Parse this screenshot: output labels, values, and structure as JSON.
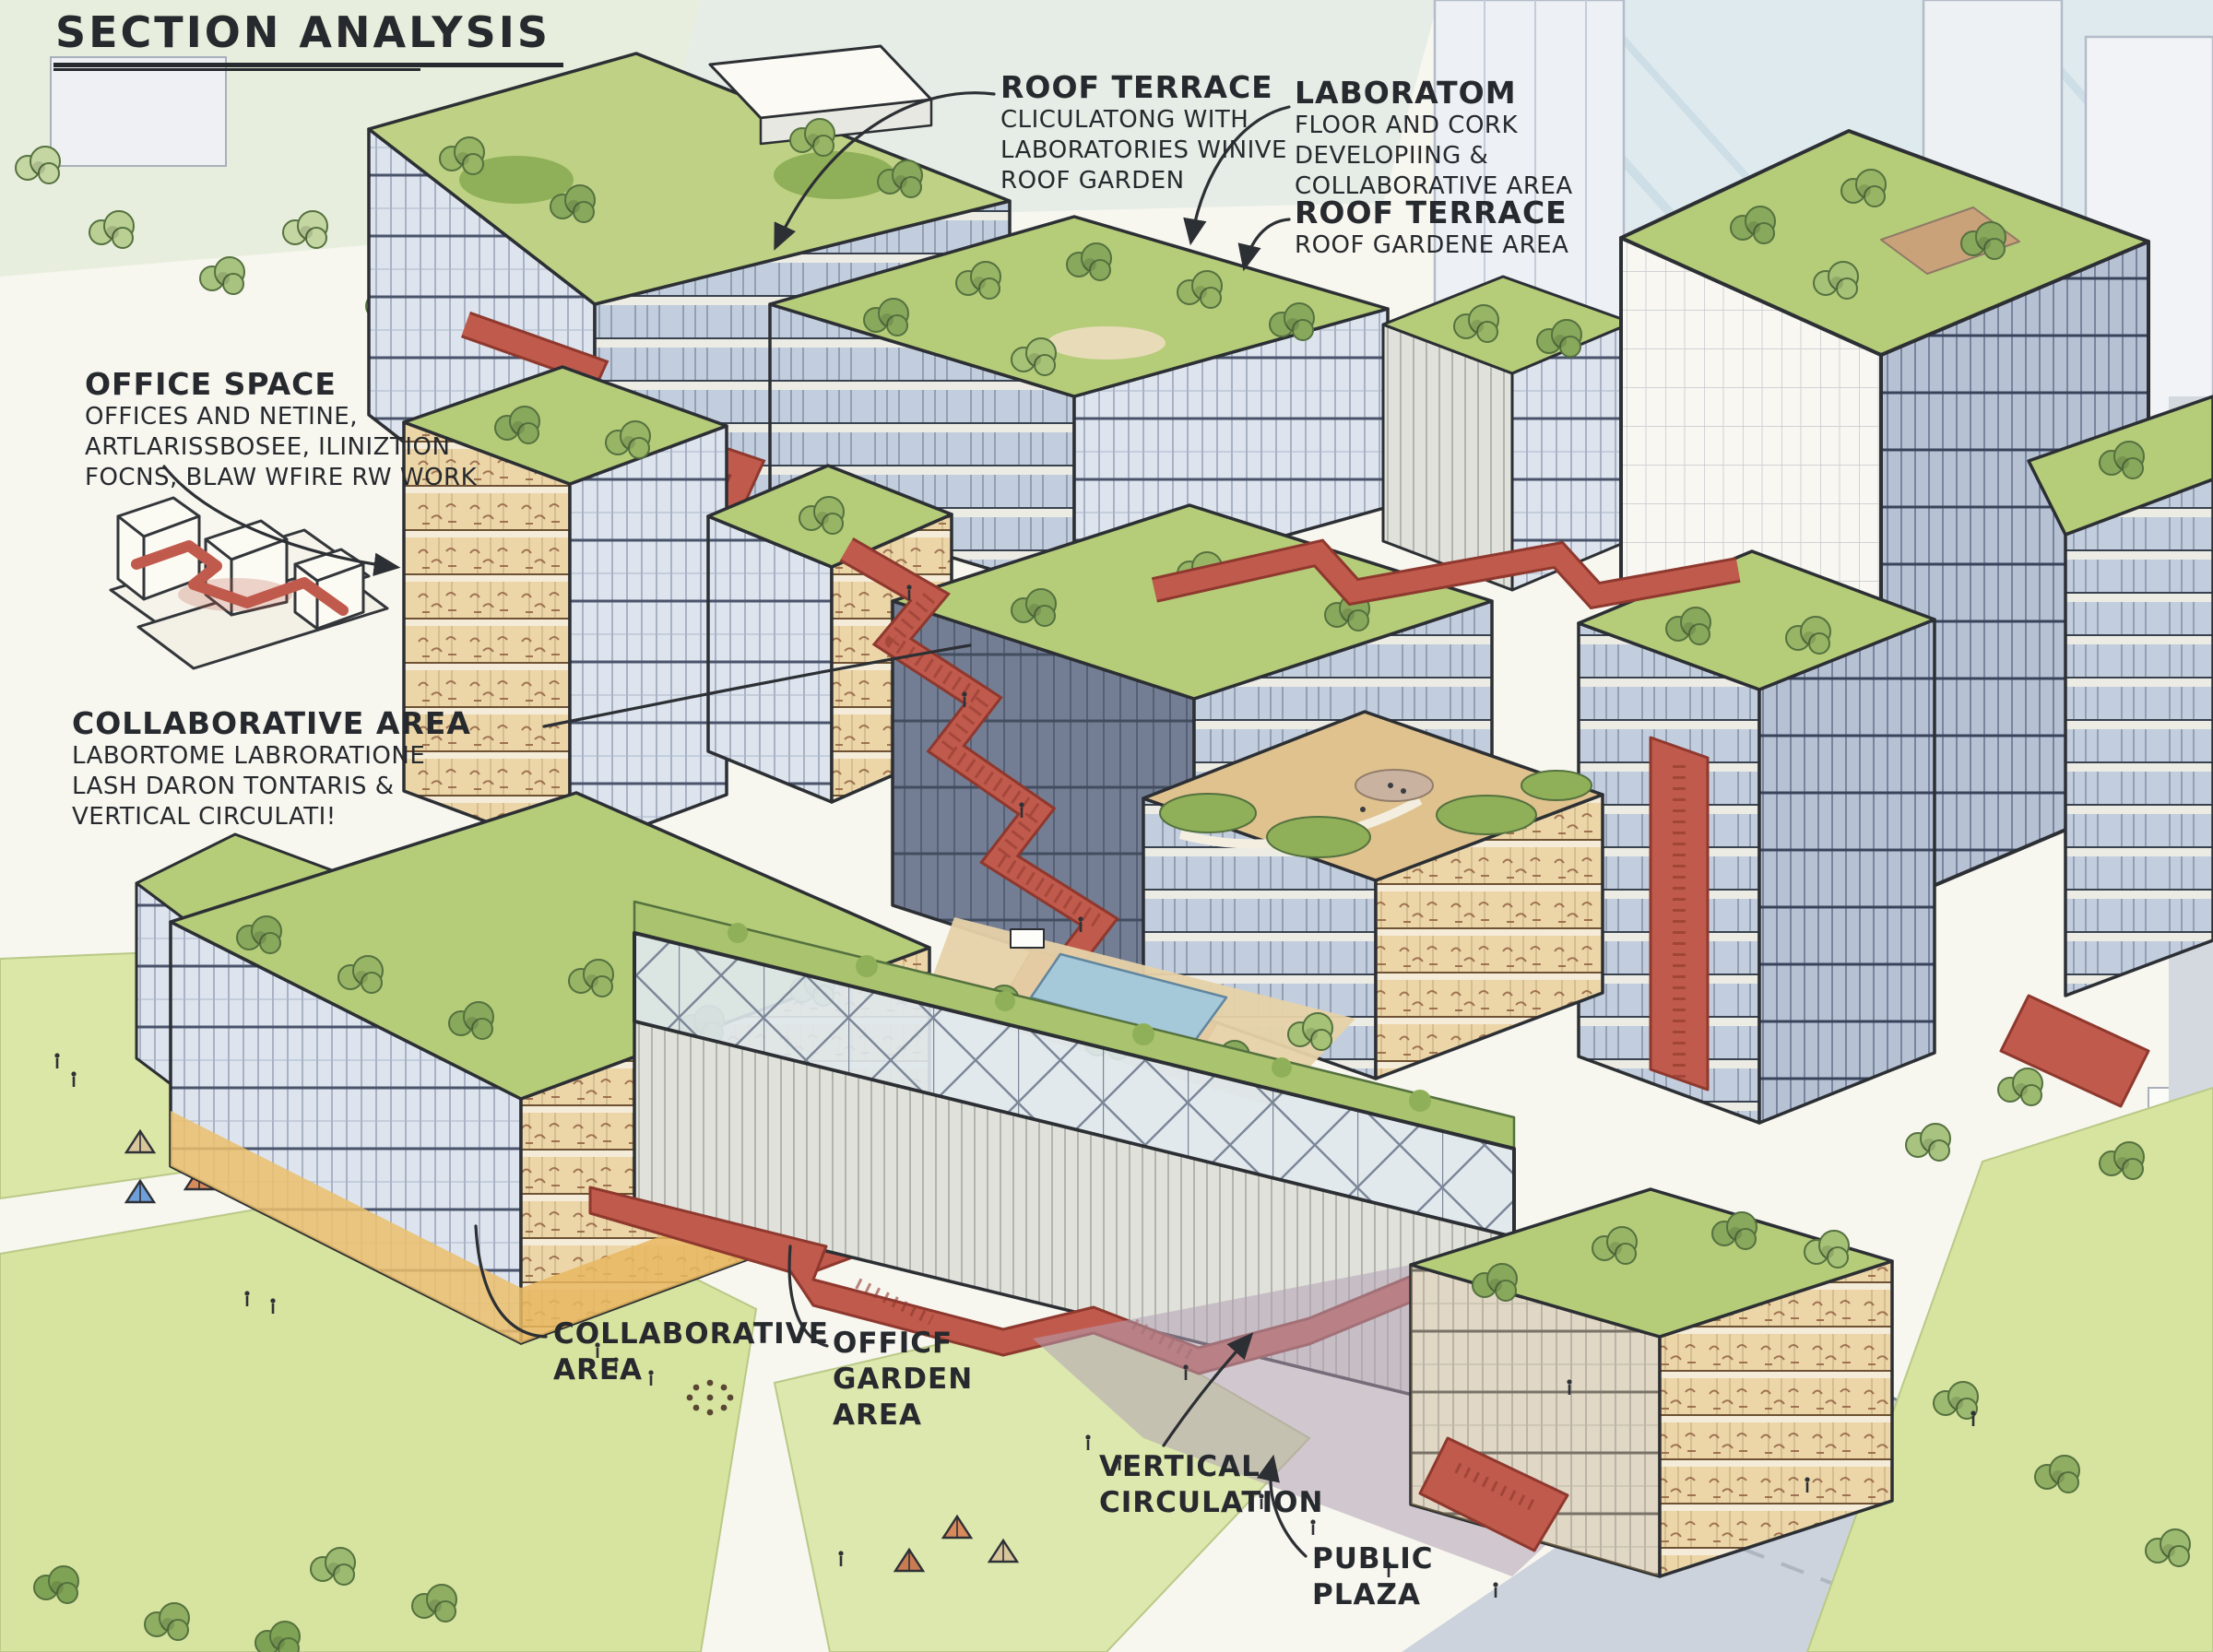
{
  "title": "SECTION ANALYSIS",
  "annotations": {
    "roof_terrace_top": {
      "heading": "ROOF TERRACE",
      "line1": "CLICULATONG WITH",
      "line2": "LABORATORIES WINIVE",
      "line3": "ROOF GARDEN"
    },
    "laboratom": {
      "heading": "LABORATOM",
      "line1": "FLOOR AND CORK",
      "line2": "DEVELOPIING &",
      "line3": "COLLABORATIVE AREA"
    },
    "roof_terrace_right": {
      "heading": "ROOF TERRACE",
      "line1": "ROOF GARDENE AREA"
    },
    "office_space": {
      "heading": "OFFICE SPACE",
      "line1": "OFFICES AND NETINE,",
      "line2": "ARTLARISSBOSEE, ILINIZTION",
      "line3": "FOCNS, BLAW WFIRE RW WORK"
    },
    "collaborative_area_left": {
      "heading": "COLLABORATIVE AREA",
      "line1": "LABORTOME LABRORATIONE",
      "line2": "LASH DARON TONTARIS &",
      "line3": "VERTICAL CIRCULATI!"
    },
    "collaborative_area_bottom": {
      "line1": "COLLABORATIVE",
      "line2": "AREA"
    },
    "office_garden_area": {
      "line1": "OFFICF",
      "line2": "GARDEN",
      "line3": "AREA"
    },
    "vertical_circulation": {
      "line1": "VERTICAL",
      "line2": "CIRCULATION"
    },
    "public_plaza": {
      "line1": "PUBLIC",
      "line2": "PLAZA"
    }
  },
  "colors": {
    "ink": "#2c2f33",
    "circulation_red": "#c05a4c",
    "roof_green": "#b5cc79",
    "glass_blue": "#c9d4e3",
    "lawn_green": "#dbe7a6",
    "paper": "#f7f6ef",
    "plaza_purple": "#b3a0b5"
  }
}
